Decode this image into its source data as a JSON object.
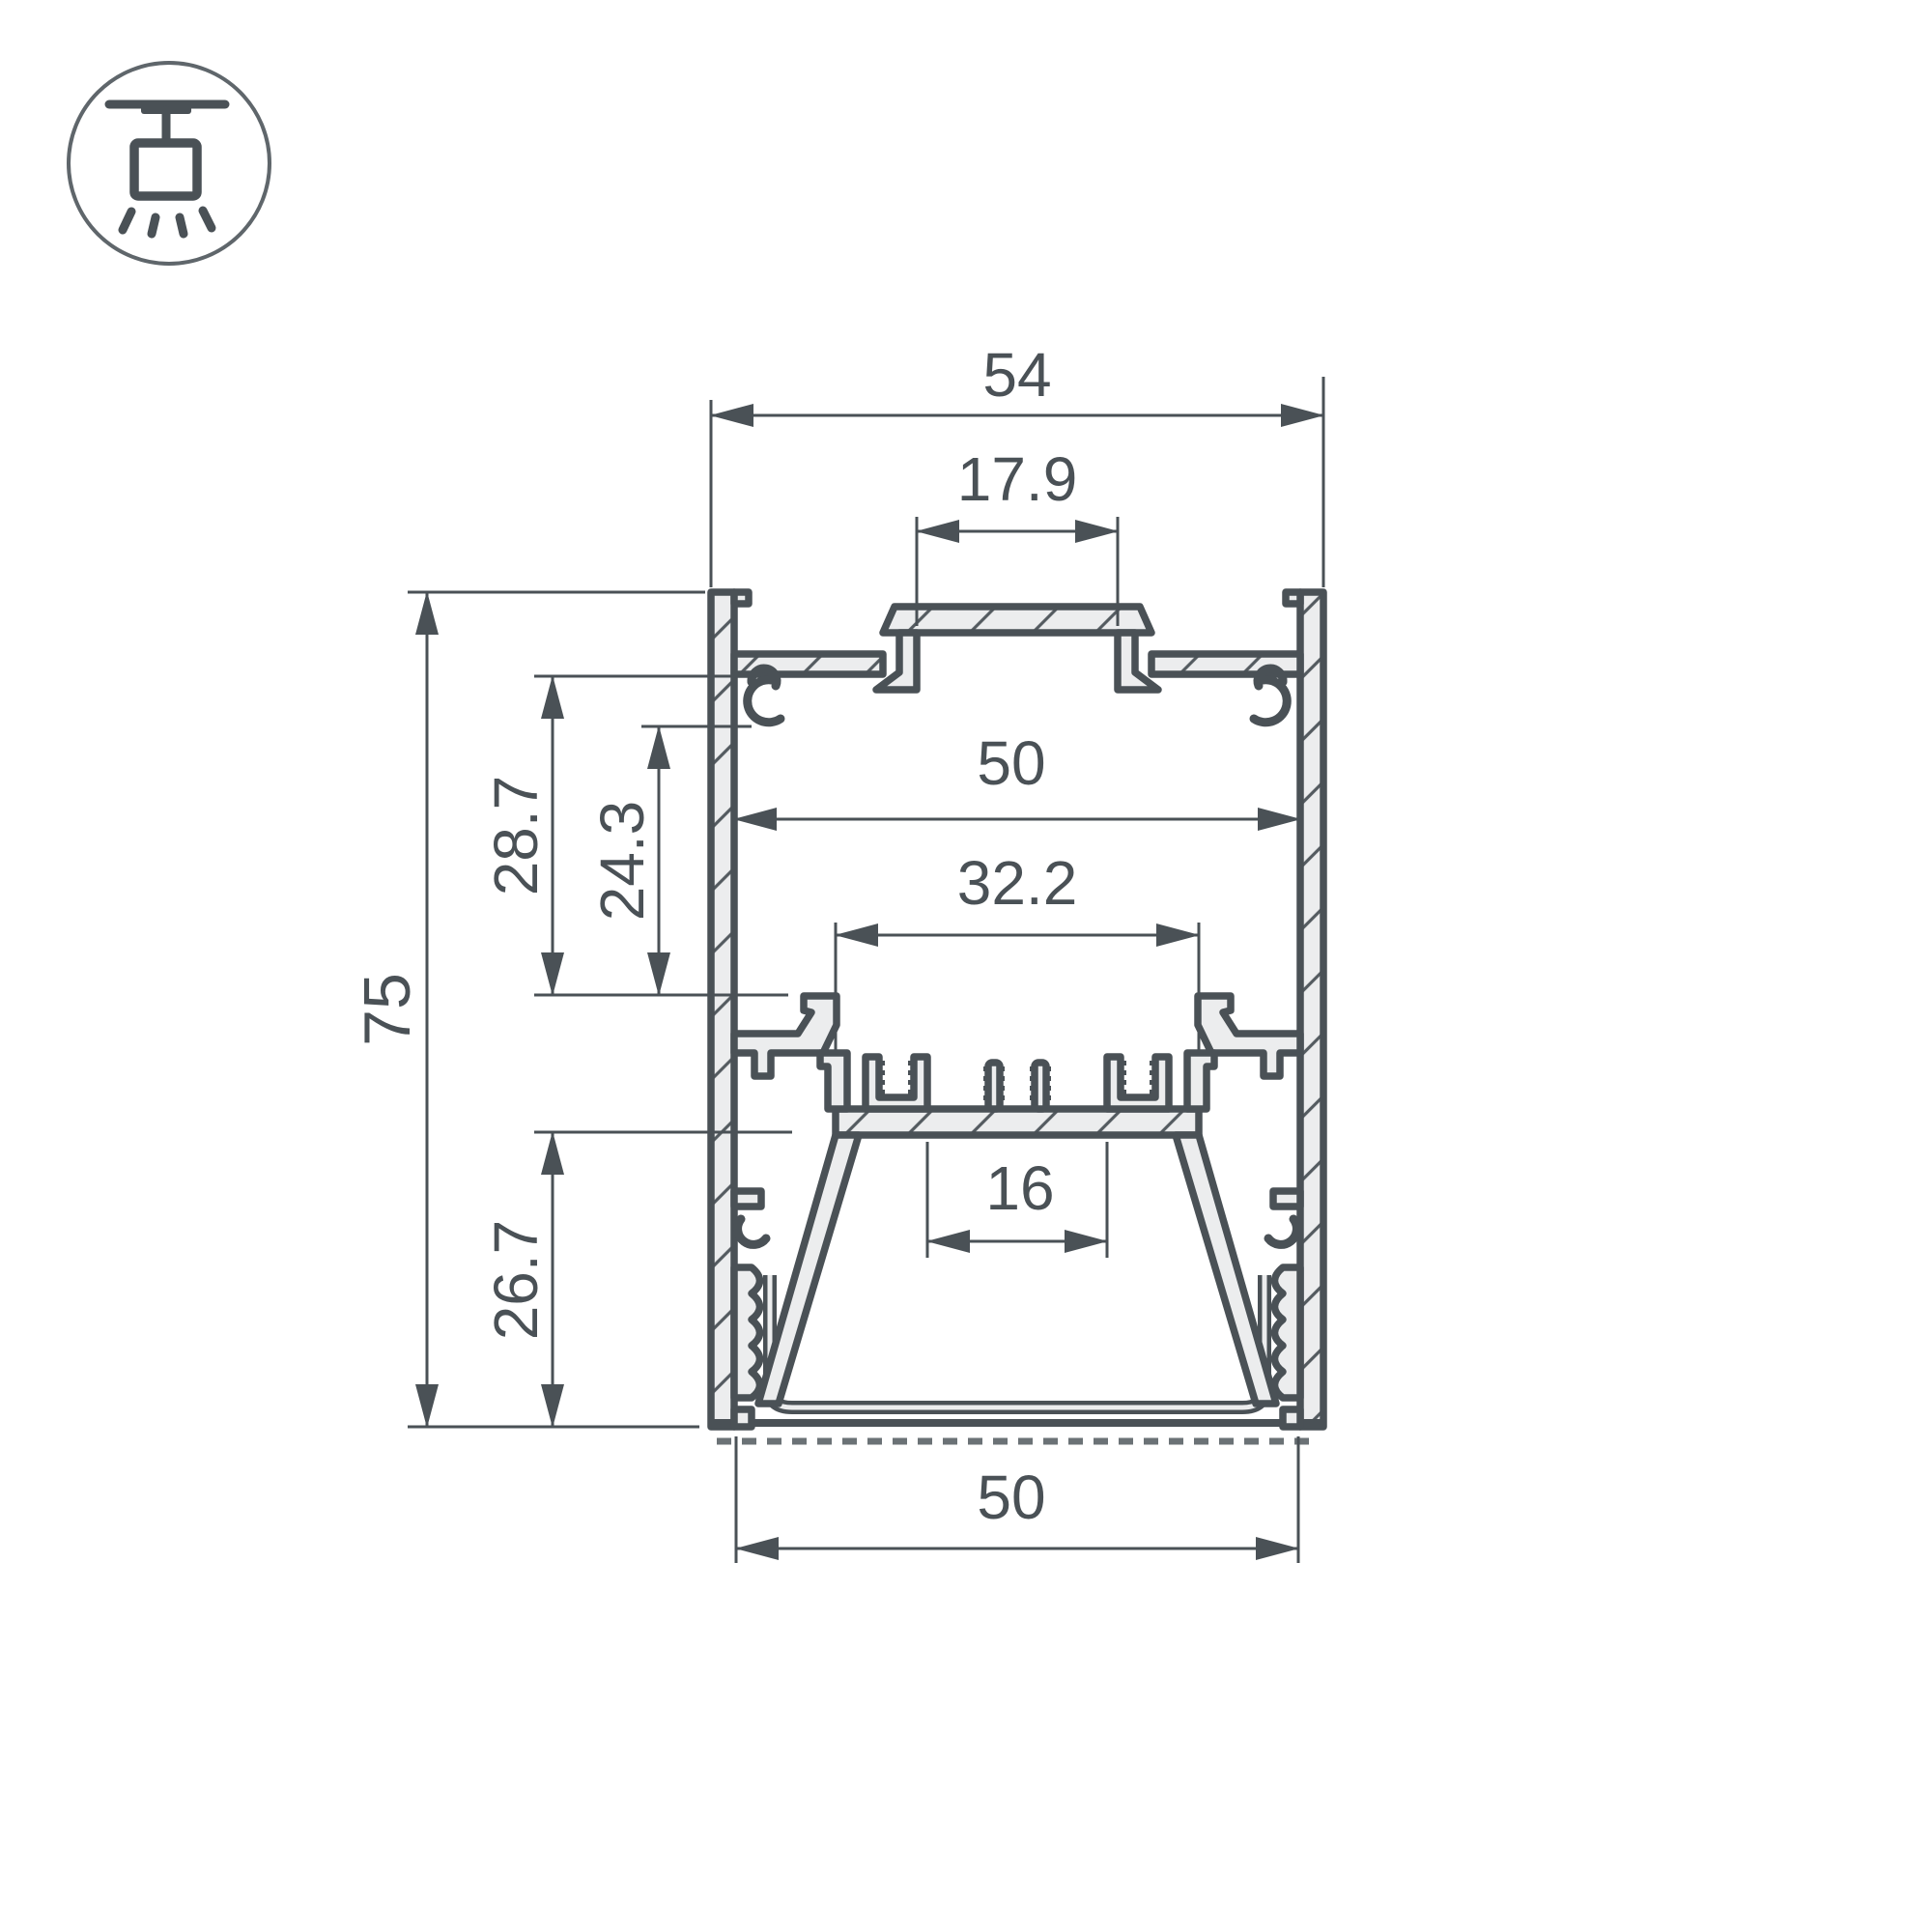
{
  "colors": {
    "line": "#4a5156",
    "fill": "#ecedee",
    "hatch": "#545b60",
    "icon": "#5f666b",
    "bg": "#ffffff"
  },
  "icon": {
    "type": "pendant-ceiling-mount"
  },
  "drawing": {
    "type": "led-profile-cross-section",
    "units": "mm",
    "dimensions": {
      "top_width": "54",
      "top_slot_width": "17.9",
      "inner_width": "50",
      "heatsink_width": "32.2",
      "upper_cavity_depth": "28.7",
      "boss_to_ledge_depth": "24.3",
      "total_height": "75",
      "lower_cavity_depth": "26.7",
      "led_channel_width": "16",
      "bottom_width": "50"
    }
  }
}
